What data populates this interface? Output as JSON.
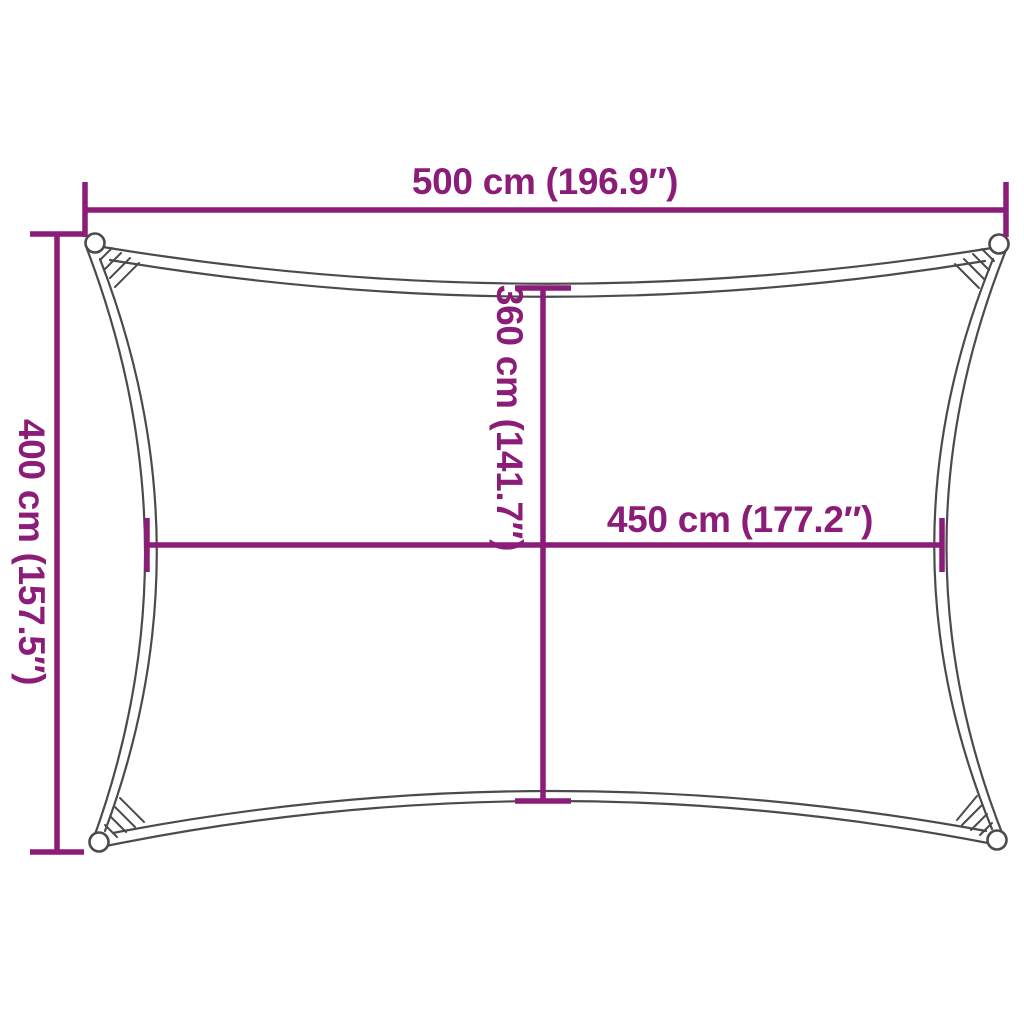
{
  "diagram": {
    "drawing_name": "rectangular-shade-sail-outline",
    "labels": {
      "width_top": "500 cm (196.9″)",
      "height_left": "400 cm (157.5″)",
      "inner_height": "360 cm (141.7″)",
      "inner_width": "450 cm (177.2″)"
    },
    "colors": {
      "dimension_lines": "#8B1C78",
      "outline": "#4B4B4B",
      "background": "#FFFFFF"
    }
  }
}
